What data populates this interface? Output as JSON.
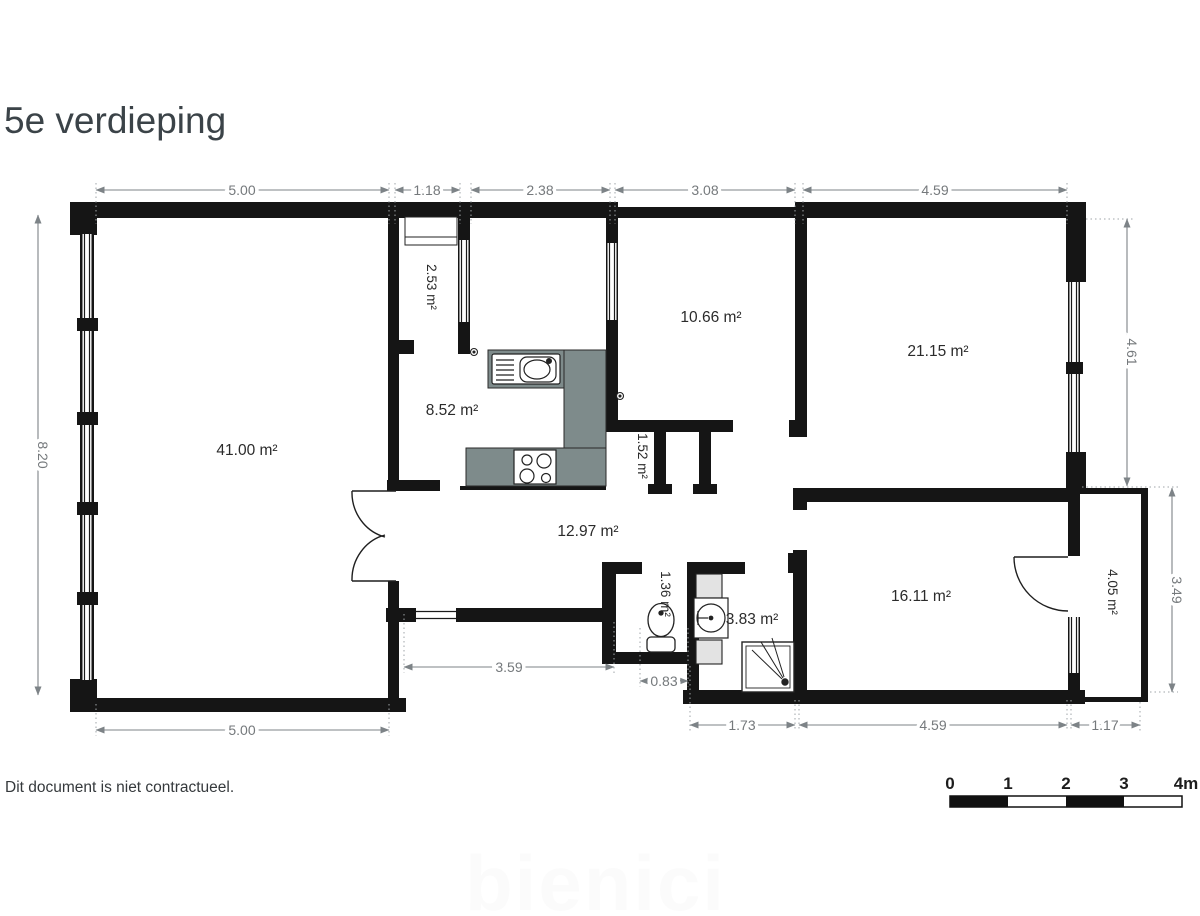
{
  "title": "5e verdieping",
  "disclaimer": "Dit document is niet contractueel.",
  "watermark": "bienici",
  "colors": {
    "wall": "#151515",
    "counter": "#7e8b8b",
    "dimension": "#7d8387",
    "title_text": "#3b4348"
  },
  "rooms": [
    {
      "name": "living-room",
      "label": "41.00 m²"
    },
    {
      "name": "entry",
      "label": "2.53 m²"
    },
    {
      "name": "kitchen",
      "label": "8.52 m²"
    },
    {
      "name": "room-top-mid",
      "label": "10.66 m²"
    },
    {
      "name": "room-top-right",
      "label": "21.15 m²"
    },
    {
      "name": "closet",
      "label": "1.52 m²"
    },
    {
      "name": "hall",
      "label": "12.97 m²"
    },
    {
      "name": "wc",
      "label": "1.36 m²"
    },
    {
      "name": "bathroom",
      "label": "3.83 m²"
    },
    {
      "name": "bedroom",
      "label": "16.11 m²"
    },
    {
      "name": "balcony",
      "label": "4.05 m²"
    }
  ],
  "dims": [
    {
      "name": "top-1",
      "label": "5.00"
    },
    {
      "name": "top-2",
      "label": "1.18"
    },
    {
      "name": "top-3",
      "label": "2.38"
    },
    {
      "name": "top-4",
      "label": "3.08"
    },
    {
      "name": "top-5",
      "label": "4.59"
    },
    {
      "name": "left-1",
      "label": "8.20"
    },
    {
      "name": "right-1",
      "label": "4.61"
    },
    {
      "name": "right-2",
      "label": "3.49"
    },
    {
      "name": "bottom-1",
      "label": "5.00"
    },
    {
      "name": "bottom-2",
      "label": "3.59"
    },
    {
      "name": "bottom-3",
      "label": "0.83"
    },
    {
      "name": "bottom-4",
      "label": "1.73"
    },
    {
      "name": "bottom-5",
      "label": "4.59"
    },
    {
      "name": "bottom-6",
      "label": "1.17"
    }
  ],
  "scale": {
    "ticks": [
      "0",
      "1",
      "2",
      "3",
      "4m"
    ]
  }
}
